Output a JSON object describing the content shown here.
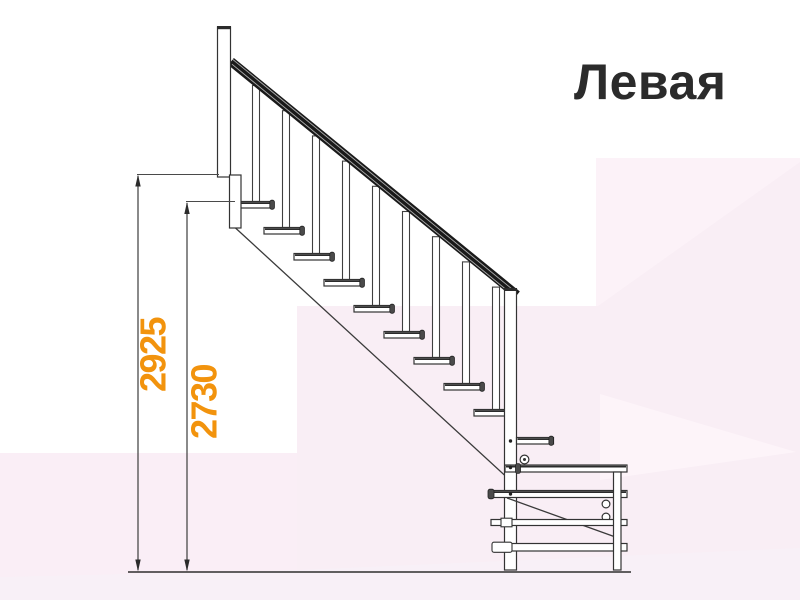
{
  "title": {
    "text": "Левая"
  },
  "drawing": {
    "type": "staircase-side-elevation",
    "dimension_labels": [
      {
        "id": "height-total",
        "value": "2925"
      },
      {
        "id": "height-floor-to-first-tread",
        "value": "2730"
      }
    ],
    "visible_elements": [
      "top-post",
      "handrail",
      "balusters",
      "treads",
      "stringer",
      "newel-post",
      "lower-platform",
      "floor-line",
      "dimension-lines"
    ],
    "treads_visible": 9,
    "balusters_visible": 9
  },
  "colors": {
    "dimension_accent": "#F2930D",
    "line": "#333333",
    "handrail": "#1A1A1A",
    "title_text": "#2B2B2B",
    "background": "#FFFFFF",
    "background_tint_1": "#F9EEF5",
    "background_tint_2": "#FCF2F8",
    "background_tint_3": "#FAEEF6",
    "background_tint_4": "#F8F0F7"
  }
}
